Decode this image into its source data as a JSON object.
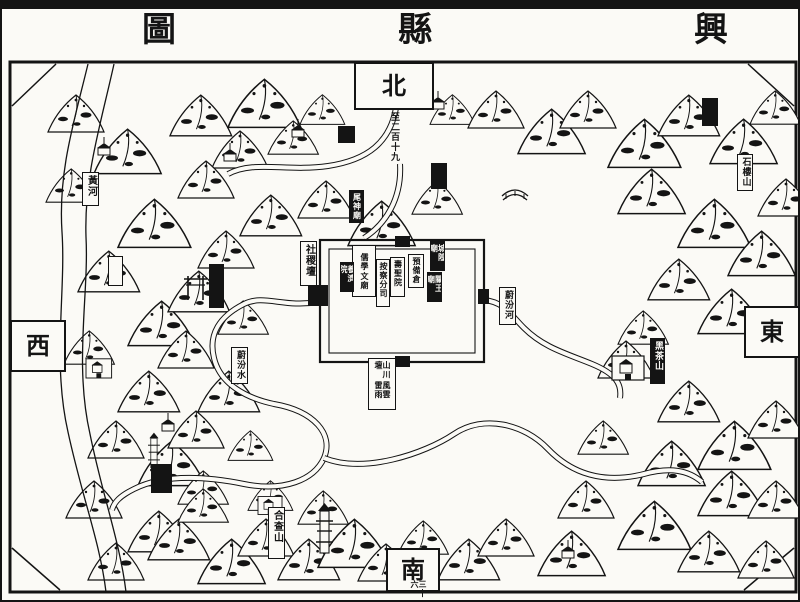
{
  "colors": {
    "ink": "#141414",
    "paper": "#fbfaf6"
  },
  "title": {
    "right": "興",
    "center": "縣",
    "left": "圖"
  },
  "cardinal": {
    "north": "北",
    "south": "南",
    "east": "東",
    "west": "西"
  },
  "notes": {
    "north_distance": "至二百十九",
    "south_distance": "三十六"
  },
  "map": {
    "labels": [
      {
        "name": "label-huanghe",
        "text": "黃河",
        "kind": "outlined",
        "x": 80,
        "y": 170,
        "w": 17,
        "h": 34,
        "fs": 10
      },
      {
        "name": "label-weifenshui",
        "text": "蔚汾水",
        "kind": "outlined",
        "x": 229,
        "y": 345,
        "w": 17,
        "h": 37,
        "fs": 9
      },
      {
        "name": "label-shejitan",
        "text": "社稷壇",
        "kind": "outlined",
        "x": 298,
        "y": 239,
        "w": 17,
        "h": 45,
        "fs": 10
      },
      {
        "name": "label-weishenmiao",
        "text": "尾神廟",
        "kind": "solid",
        "x": 347,
        "y": 188,
        "w": 15,
        "h": 33,
        "fs": 8
      },
      {
        "name": "label-weifenhe",
        "text": "蔚汾河",
        "kind": "outlined",
        "x": 497,
        "y": 285,
        "w": 17,
        "h": 38,
        "fs": 9
      },
      {
        "name": "label-shiloushan",
        "text": "石樓山",
        "kind": "outlined",
        "x": 735,
        "y": 152,
        "w": 16,
        "h": 37,
        "fs": 9
      },
      {
        "name": "label-heichashan",
        "text": "黑茶山",
        "kind": "solid",
        "x": 648,
        "y": 336,
        "w": 15,
        "h": 46,
        "fs": 9
      },
      {
        "name": "label-hechashan",
        "text": "合查山",
        "kind": "outlined",
        "x": 266,
        "y": 505,
        "w": 17,
        "h": 52,
        "fs": 10
      },
      {
        "name": "label-chenghuangmiao",
        "text": "城隍廟",
        "kind": "solid",
        "x": 428,
        "y": 239,
        "w": 15,
        "h": 30,
        "fs": 8
      },
      {
        "name": "label-guanwangmiao",
        "text": "關王廟",
        "kind": "solid",
        "x": 425,
        "y": 270,
        "w": 15,
        "h": 30,
        "fs": 8
      },
      {
        "name": "label-yubeicang",
        "text": "預備倉",
        "kind": "outlined",
        "x": 406,
        "y": 252,
        "w": 16,
        "h": 34,
        "fs": 8
      },
      {
        "name": "label-shoushengyuan",
        "text": "壽聖院",
        "kind": "outlined",
        "x": 388,
        "y": 255,
        "w": 15,
        "h": 40,
        "fs": 8
      },
      {
        "name": "label-anchafensi",
        "text": "按察分司",
        "kind": "outlined",
        "x": 374,
        "y": 257,
        "w": 14,
        "h": 48,
        "fs": 8
      },
      {
        "name": "label-wenmiao-ruxue",
        "cols": [
          "文廟",
          "儒學"
        ],
        "kind": "outlined",
        "x": 350,
        "y": 243,
        "w": 24,
        "h": 52,
        "fs": 8
      },
      {
        "name": "label-yangjiyuan",
        "text": "養濟院",
        "kind": "solid",
        "x": 338,
        "y": 260,
        "w": 14,
        "h": 30,
        "fs": 8
      },
      {
        "name": "label-shanchuantan",
        "cols": [
          "風雲雷雨",
          "山川壇"
        ],
        "kind": "outlined",
        "x": 366,
        "y": 356,
        "w": 28,
        "h": 52,
        "fs": 8
      }
    ],
    "marks": [
      {
        "name": "illegible-cartouche",
        "kind": "solid",
        "x": 700,
        "y": 96,
        "w": 14,
        "h": 26
      },
      {
        "name": "illegible-cartouche",
        "kind": "solid",
        "x": 336,
        "y": 124,
        "w": 15,
        "h": 15
      },
      {
        "name": "illegible-cartouche",
        "kind": "solid",
        "x": 429,
        "y": 161,
        "w": 14,
        "h": 24
      },
      {
        "name": "illegible-cartouche",
        "kind": "solid",
        "x": 207,
        "y": 262,
        "w": 13,
        "h": 42
      },
      {
        "name": "illegible-cartouche",
        "kind": "solid",
        "x": 149,
        "y": 462,
        "w": 19,
        "h": 27
      },
      {
        "name": "illegible-cartouche",
        "kind": "outlined",
        "x": 106,
        "y": 254,
        "w": 13,
        "h": 28
      },
      {
        "name": "city-west-gate",
        "kind": "solid",
        "x": 306,
        "y": 283,
        "w": 18,
        "h": 19
      },
      {
        "name": "city-east-gate",
        "kind": "solid",
        "x": 476,
        "y": 287,
        "w": 9,
        "h": 13
      },
      {
        "name": "city-north-gate",
        "kind": "solid",
        "x": 393,
        "y": 234,
        "w": 13,
        "h": 9
      },
      {
        "name": "city-south-gate",
        "kind": "solid",
        "x": 393,
        "y": 354,
        "w": 13,
        "h": 9
      }
    ]
  }
}
